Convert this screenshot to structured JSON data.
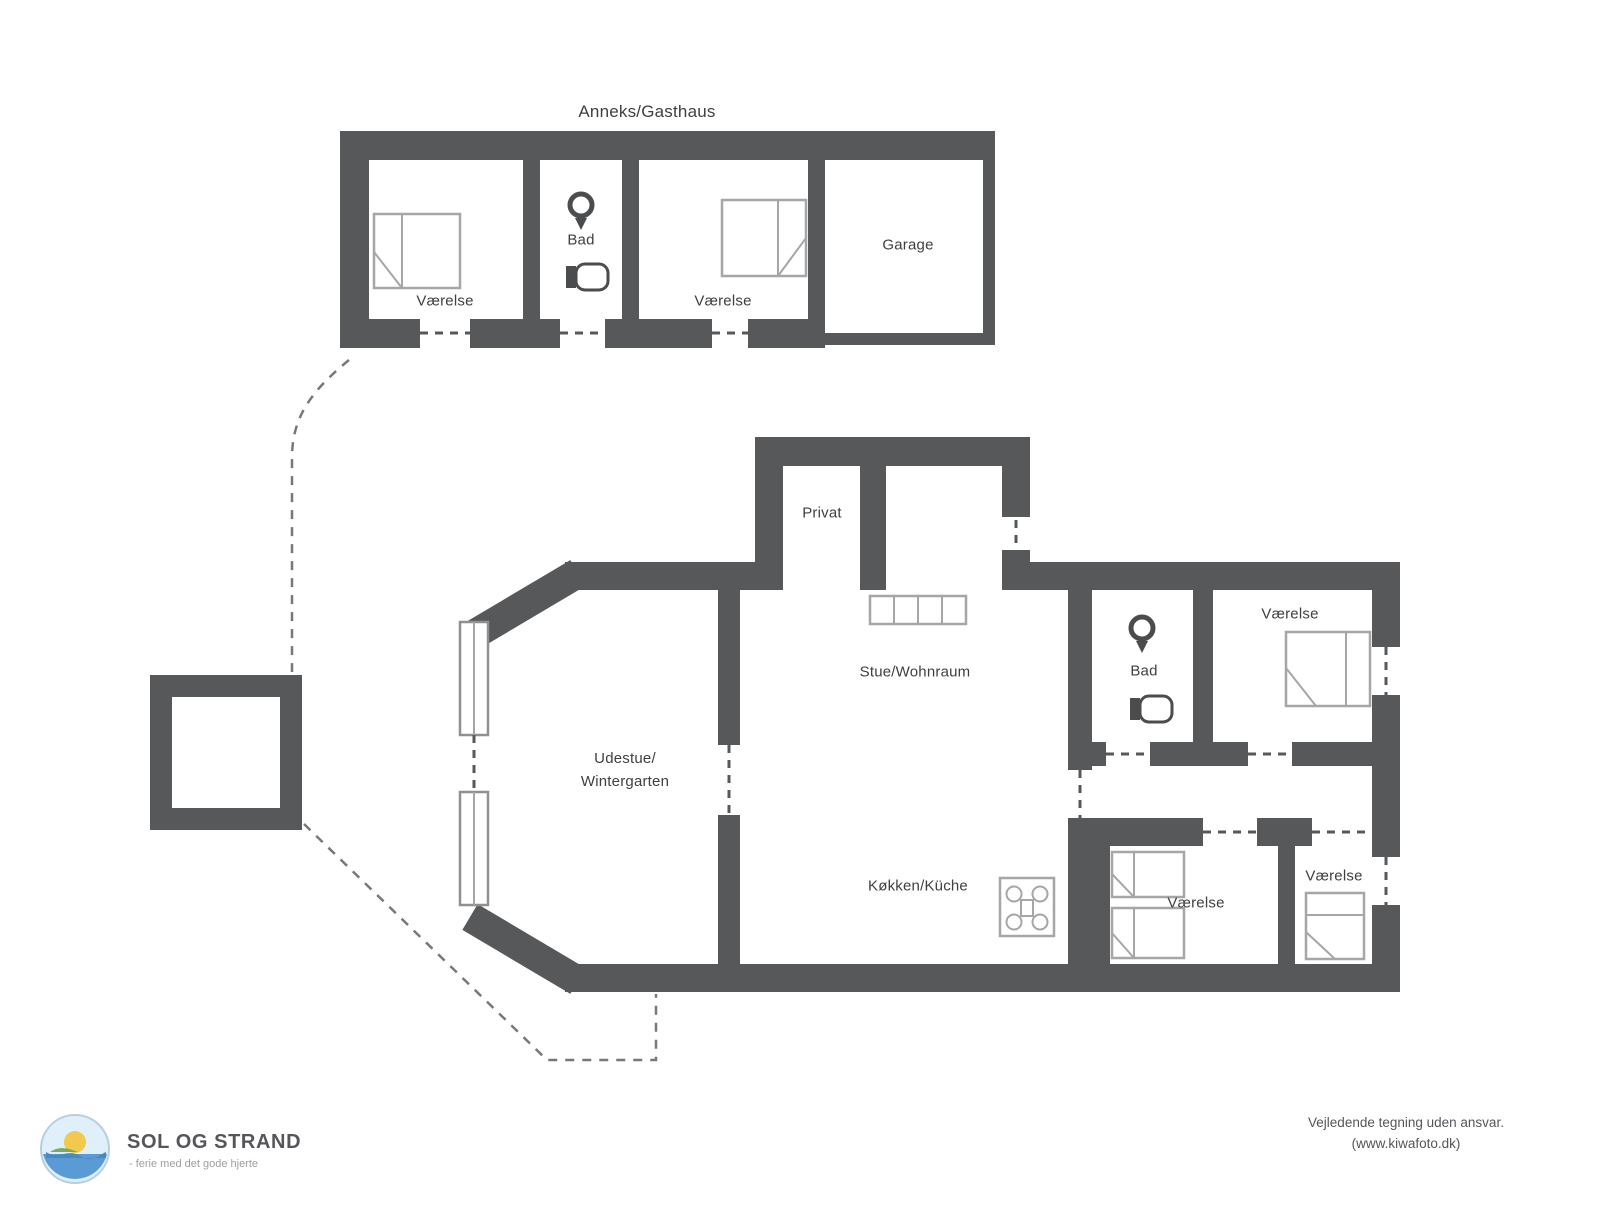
{
  "labels": {
    "annex_title": "Anneks/Gasthaus",
    "annex_vaerelse_1": "Værelse",
    "annex_bad": "Bad",
    "annex_vaerelse_2": "Værelse",
    "annex_garage": "Garage",
    "privat": "Privat",
    "stue": "Stue/Wohnraum",
    "udestue_line1": "Udestue/",
    "udestue_line2": "Wintergarten",
    "koekken": "Køkken/Küche",
    "bad": "Bad",
    "vaerelse_nord": "Værelse",
    "vaerelse_syd_vest": "Værelse",
    "vaerelse_syd_oest": "Værelse"
  },
  "footer": {
    "brand": "SOL OG STRAND",
    "tagline": "- ferie med det gode hjerte",
    "disclaimer_line1": "Vejledende tegning uden ansvar.",
    "disclaimer_line2": "(www.kiwafoto.dk)"
  },
  "icons": [
    "double-bed-icon",
    "single-bed-icon",
    "toilet-icon",
    "sink-icon",
    "stove-icon",
    "sideboard-icon",
    "sun-and-beach-logo-icon"
  ],
  "colors": {
    "wall": "#57585a",
    "furniture_line": "#a6a6a6",
    "dash_line": "#77787a",
    "label_text": "#3f3f40",
    "brand_text": "#55565a",
    "muted_text": "#9c9ea0"
  }
}
